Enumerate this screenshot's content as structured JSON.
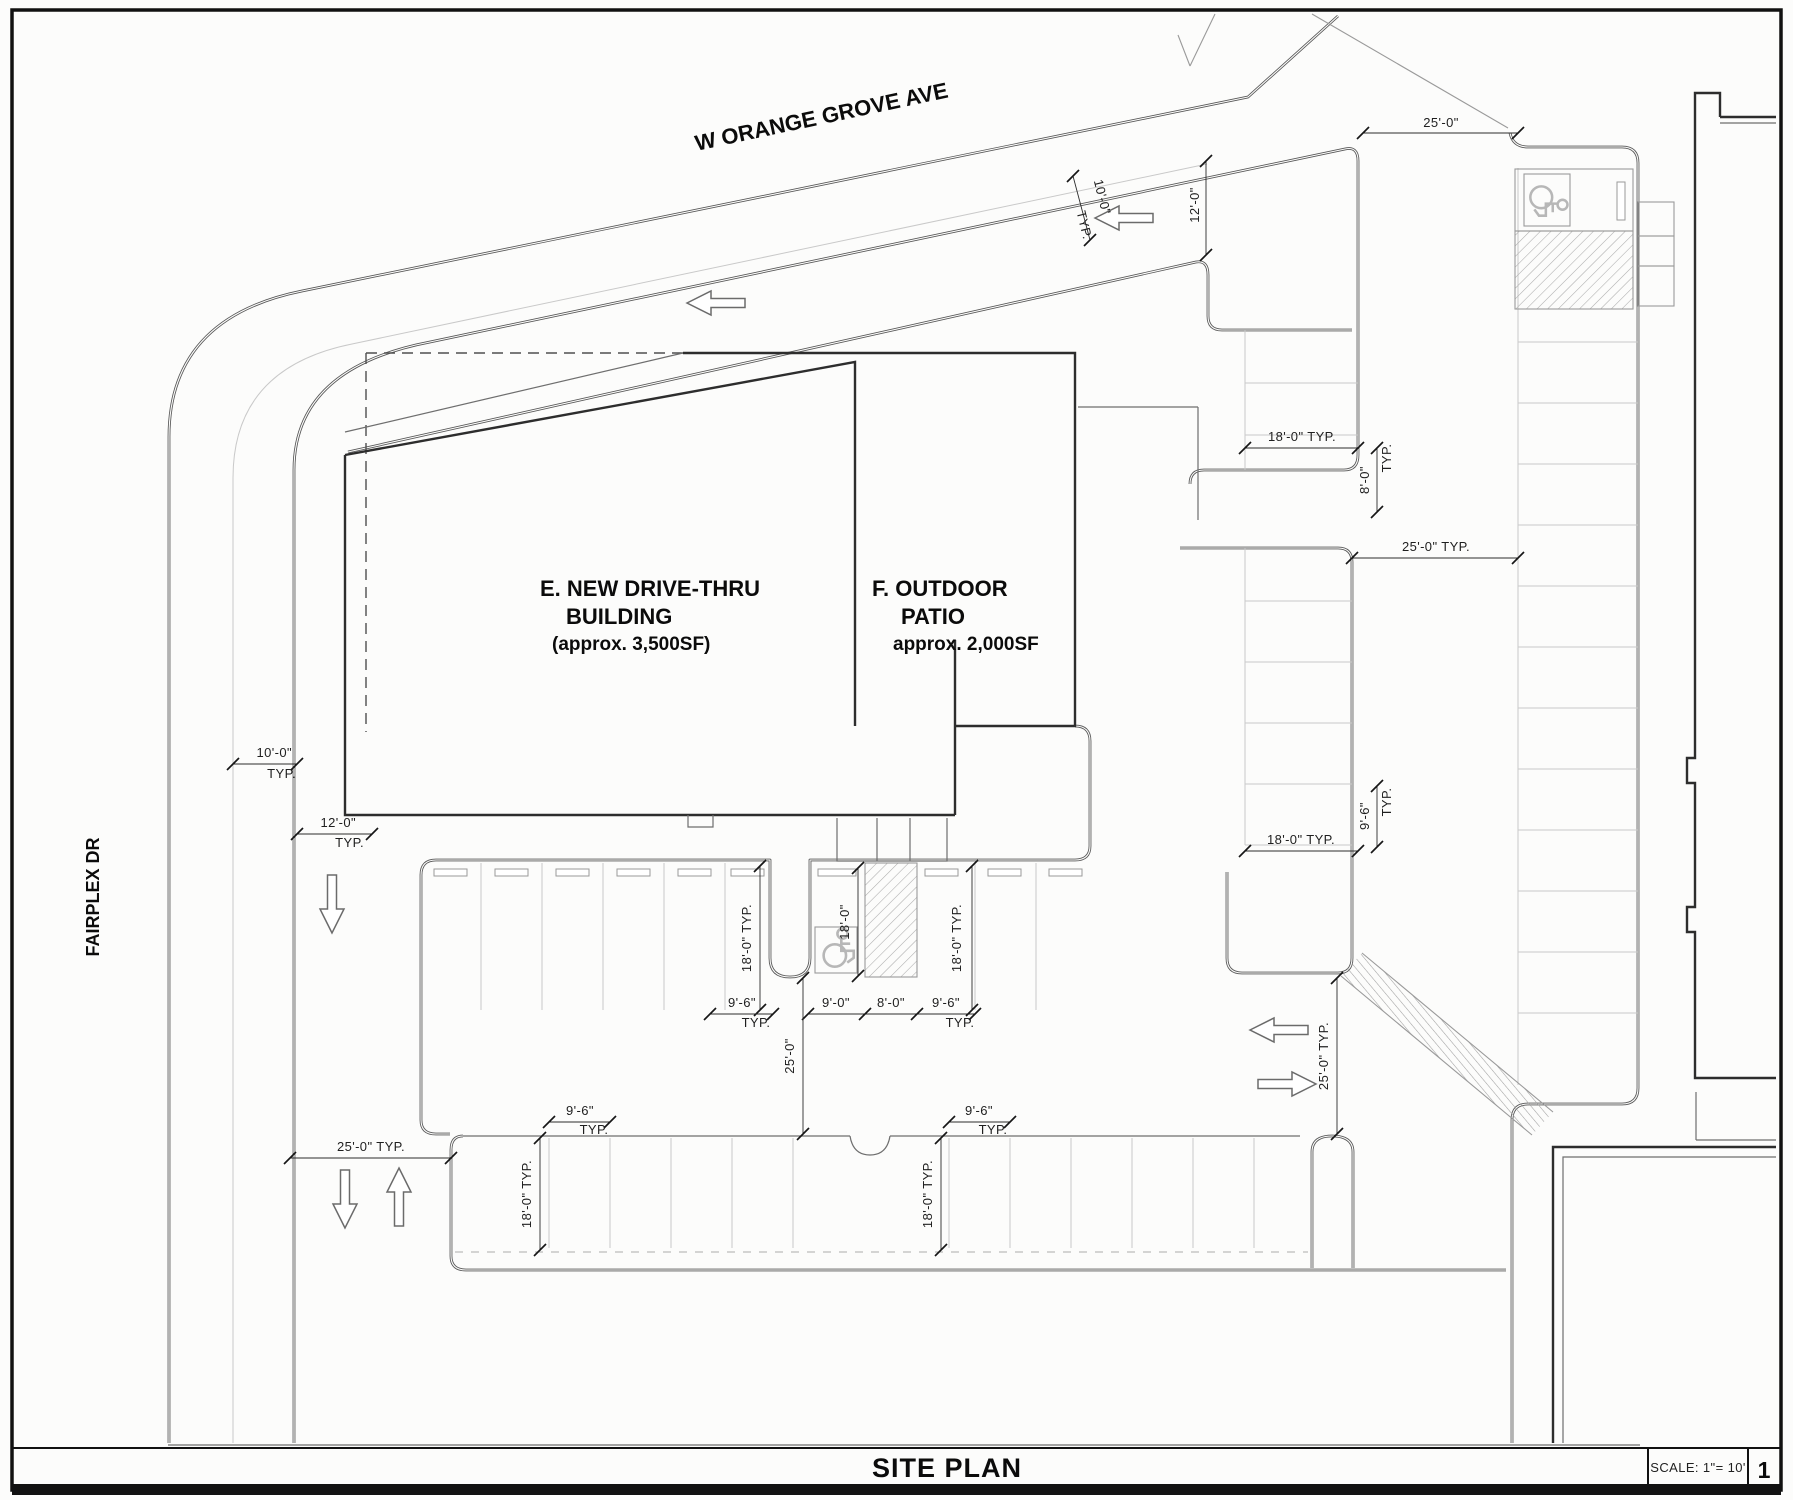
{
  "sheet": {
    "title": "SITE PLAN",
    "scale_label": "SCALE: 1\"= 10'",
    "number": "1"
  },
  "streets": {
    "top": "W ORANGE GROVE AVE",
    "left": "FAIRPLEX DR"
  },
  "buildings": {
    "drive_thru": {
      "line1": "E. NEW DRIVE-THRU",
      "line2": "BUILDING",
      "line3": "(approx. 3,500SF)"
    },
    "patio": {
      "line1": "F. OUTDOOR",
      "line2": "PATIO",
      "line3": "approx. 2,000SF"
    }
  },
  "dims": {
    "ft25": "25'-0\"",
    "ft25typ": "25'-0\" TYP.",
    "ft12": "12'-0\"",
    "ft10": "10'-0\"",
    "ft18": "18'-0\"",
    "ft18typ": "18'-0\" TYP.",
    "ft8": "8'-0\"",
    "ft9": "9'-0\"",
    "ft96": "9'-6\"",
    "typ": "TYP."
  },
  "icons": {
    "accessible_parking": "wheelchair-symbol",
    "direction_arrow": "outline-arrow"
  },
  "colors": {
    "paper": "#fcfcfb",
    "wall": "#2d2d2d",
    "curb": "#575757",
    "faint": "#c9c9c9",
    "hatch": "#ababab",
    "ink": "#1a1a1a"
  }
}
